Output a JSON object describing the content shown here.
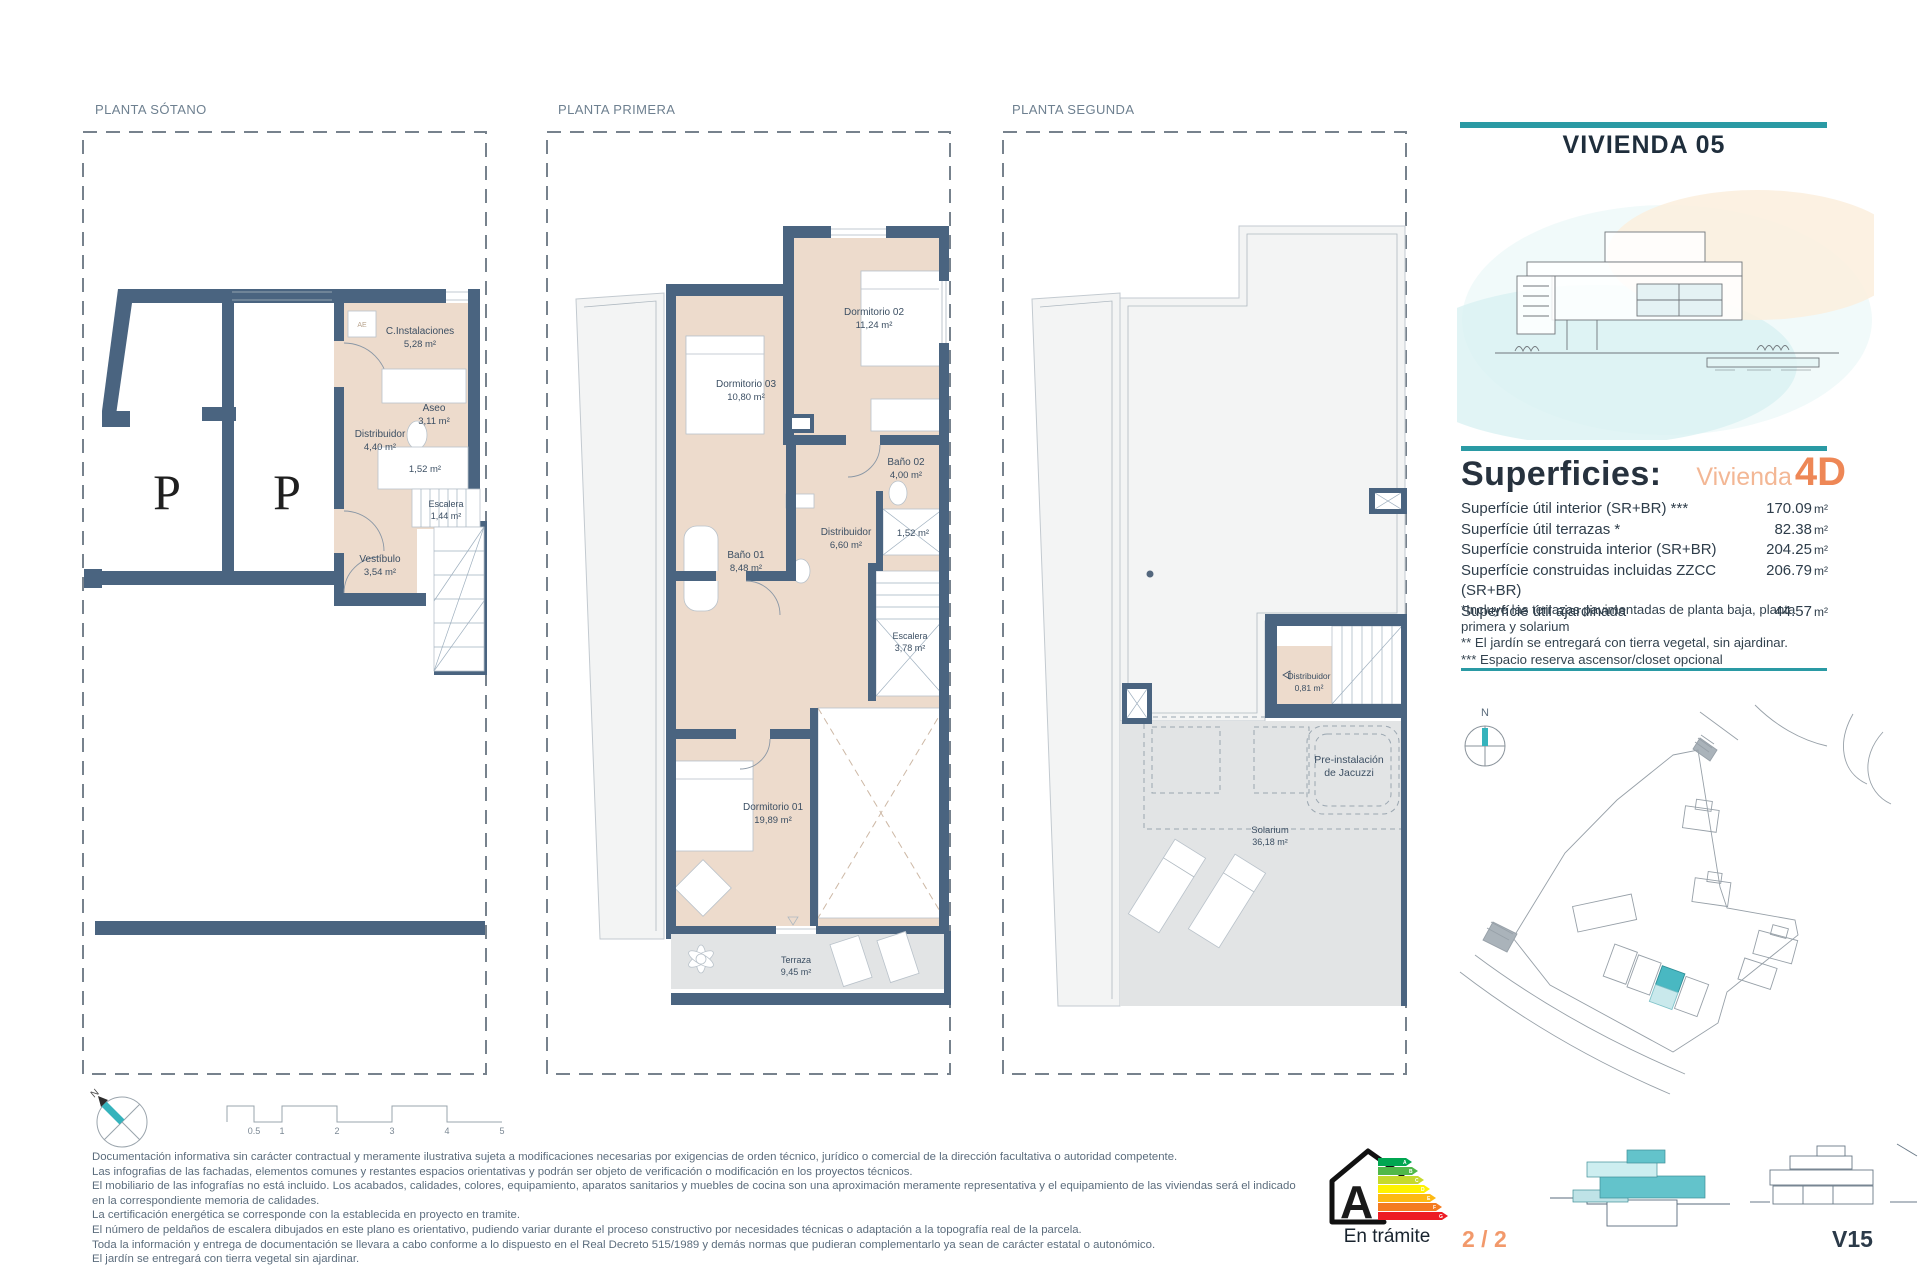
{
  "header": {
    "title": "VIVIENDA 05"
  },
  "plans": [
    {
      "title": "PLANTA SÓTANO",
      "parking": [
        "P",
        "P"
      ],
      "ae": "AE",
      "rooms": [
        {
          "name": "C.Instalaciones",
          "area": "5,28 m²"
        },
        {
          "name": "Aseo",
          "area": "3,11 m²"
        },
        {
          "name": "Distribuidor",
          "area": "4,40 m²"
        },
        {
          "name": "",
          "area": "1,52 m²"
        },
        {
          "name": "Escalera",
          "area": "1,44 m²"
        },
        {
          "name": "Vestíbulo",
          "area": "3,54 m²"
        }
      ]
    },
    {
      "title": "PLANTA PRIMERA",
      "rooms": [
        {
          "name": "Dormitorio 02",
          "area": "11,24 m²"
        },
        {
          "name": "Dormitorio 03",
          "area": "10,80 m²"
        },
        {
          "name": "Baño 02",
          "area": "4,00 m²"
        },
        {
          "name": "Baño 01",
          "area": "8,48 m²"
        },
        {
          "name": "Distribuidor",
          "area": "6,60 m²"
        },
        {
          "name": "",
          "area": "1,52 m²"
        },
        {
          "name": "Escalera",
          "area": "3,78 m²"
        },
        {
          "name": "Dormitorio 01",
          "area": "19,89 m²"
        },
        {
          "name": "Terraza",
          "area": "9,45 m²"
        }
      ]
    },
    {
      "title": "PLANTA SEGUNDA",
      "rooms": [
        {
          "name": "Distribuidor",
          "area": "0,81 m²"
        },
        {
          "name": "Pre-instalación",
          "area": "de Jacuzzi"
        },
        {
          "name": "Solarium",
          "area": "36,18 m²"
        }
      ]
    }
  ],
  "superficies": {
    "heading": "Superficies:",
    "vivienda_word": "Vivienda",
    "vivienda_type": "4D",
    "rows": [
      {
        "label": "Superfície útil interior (SR+BR) ***",
        "value": "170.09",
        "unit": "m²"
      },
      {
        "label": "Superfície útil terrazas *",
        "value": "82.38",
        "unit": "m²"
      },
      {
        "label": "Superfície construida interior (SR+BR)",
        "value": "204.25",
        "unit": "m²"
      },
      {
        "label": "Superfície construidas incluidas ZZCC (SR+BR)",
        "value": "206.79",
        "unit": "m²"
      },
      {
        "label": "Superfície útil ajardinada",
        "value": "44.57",
        "unit": "m²"
      }
    ],
    "notes": [
      "*Incluye las terrazas pavimentadas de planta baja, planta primera y solarium",
      "** El jardín se entregará con tierra vegetal, sin ajardinar.",
      "*** Espacio reserva ascensor/closet opcional"
    ]
  },
  "compass": {
    "north_label": "N"
  },
  "site_compass": {
    "north_label": "N"
  },
  "scale_bar": {
    "ticks": [
      "0.5",
      "1",
      "2",
      "3",
      "4",
      "5"
    ]
  },
  "legal": {
    "lines": [
      "Documentación informativa sin carácter contractual y meramente ilustrativa sujeta a modificaciones necesarias por exigencias de orden técnico, jurídico o comercial de la dirección facultativa o autoridad competente.",
      "Las infografias de las fachadas, elementos comunes y restantes espacios orientativas y podrán ser objeto de verificación o modificación en los proyectos técnicos.",
      "El mobiliario de las infografías no está incluido. Los acabados, calidades, colores, equipamiento, aparatos sanitarios y muebles de cocina son una aproximación meramente representativa y el equipamiento de las viviendas será el indicado en la correspondiente memoria de calidades.",
      "La certificación energética se corresponde con la establecida en proyecto en tramite.",
      "El número de peldaños de escalera dibujados en este plano es orientativo, pudiendo variar durante el proceso constructivo por necesidades técnicas o adaptación a la topografía real de la parcela.",
      "Toda la información y entrega de documentación se llevara a cabo conforme a lo dispuesto en el Real Decreto 515/1989 y demás normas que pudieran complementarlo ya sean de carácter estatal o autonómico.",
      "El jardín se entregará con tierra vegetal sin ajardinar."
    ]
  },
  "energy": {
    "letter": "A",
    "status": "En trámite",
    "colors": [
      "#00a651",
      "#50b848",
      "#c5d92d",
      "#fff200",
      "#fdb913",
      "#f47b20",
      "#ed1c24"
    ],
    "scale_letters": [
      "A",
      "B",
      "C",
      "D",
      "E",
      "F",
      "G"
    ]
  },
  "footer": {
    "page": "2 / 2",
    "reference": "V15"
  },
  "colors": {
    "teal": "#2a9aa4",
    "orange": "#ee8756",
    "wall": "#4a6480",
    "beige": "#eddbcc"
  }
}
